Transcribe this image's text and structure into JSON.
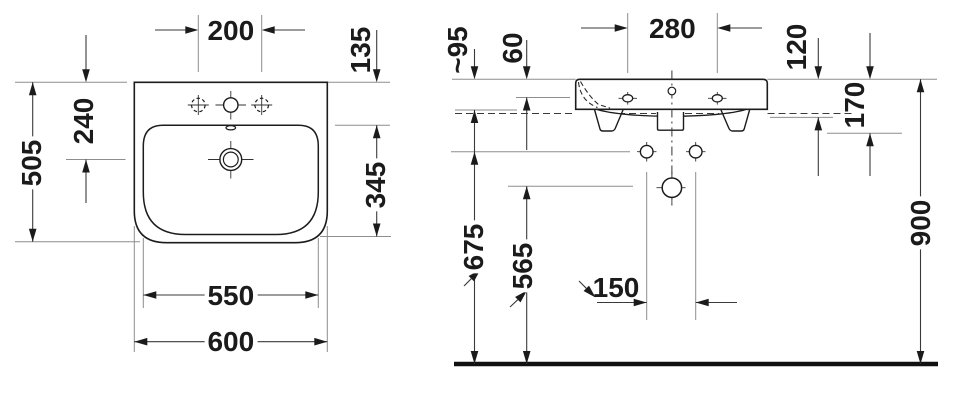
{
  "top_view": {
    "dims": {
      "tap_holes_spacing": "200",
      "rim_to_inner_top": "135",
      "overall_depth": "505",
      "rim_to_drain": "240",
      "inner_depth": "345",
      "inner_width": "550",
      "overall_width": "600"
    }
  },
  "side_view": {
    "dims": {
      "rim_height": "~95",
      "top_to_fixing_line": "60",
      "fixing_holes_spacing": "280",
      "front_lip_height": "120",
      "body_height": "170",
      "floor_to_lower_holes": "675",
      "floor_to_drain": "565",
      "lower_holes_spacing": "150",
      "floor_to_rim": "900"
    }
  }
}
